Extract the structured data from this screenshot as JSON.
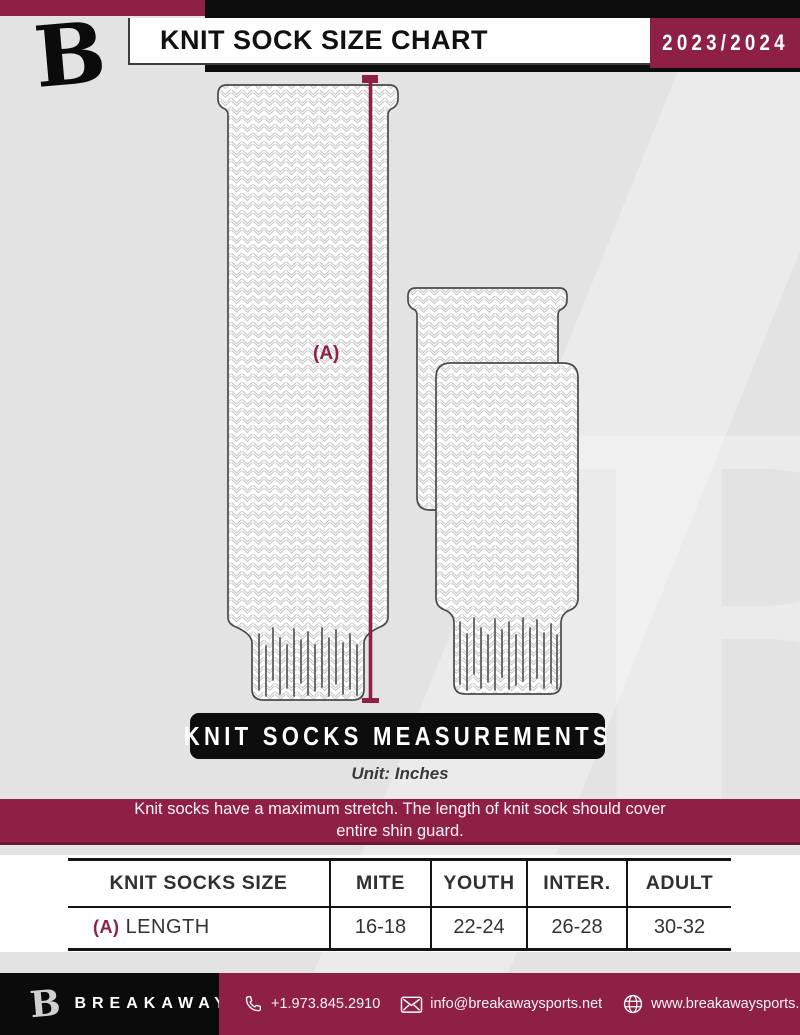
{
  "colors": {
    "maroon": "#8d2044",
    "black": "#0d0d0d",
    "page_bg": "#e4e3e3",
    "knit_line": "#c2c0c0"
  },
  "watermark": {
    "letter": "B"
  },
  "header": {
    "logo_letter": "B",
    "title": "KNIT SOCK SIZE CHART",
    "season": "2023/2024"
  },
  "diagram": {
    "dimension_label": "(A)",
    "banner": "KNIT SOCKS MEASUREMENTS",
    "unit_note": "Unit: Inches"
  },
  "notice": {
    "line1": "Knit socks have a maximum stretch. The length of knit sock should cover",
    "line2": "entire shin guard."
  },
  "size_table": {
    "headers": [
      "KNIT SOCKS SIZE",
      "MITE",
      "YOUTH",
      "INTER.",
      "ADULT"
    ],
    "row": {
      "label_key": "(A)",
      "label": "LENGTH",
      "values": [
        "16-18",
        "22-24",
        "26-28",
        "30-32"
      ]
    }
  },
  "footer": {
    "logo_letter": "B",
    "brand": "BREAKAWAY",
    "phone": "+1.973.845.2910",
    "email": "info@breakawaysports.net",
    "website": "www.breakawaysports.net"
  }
}
